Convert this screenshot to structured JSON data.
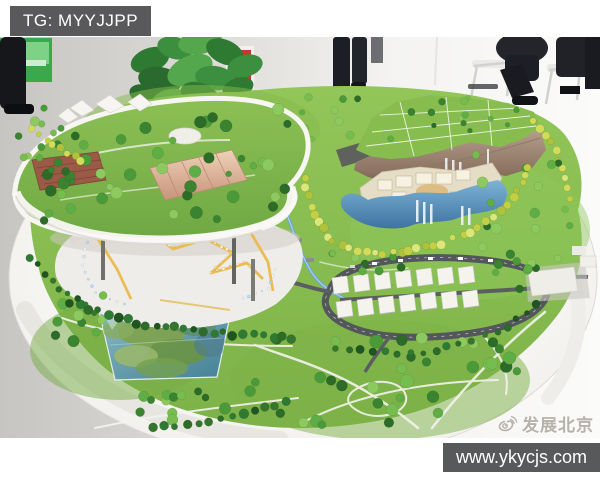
{
  "overlays": {
    "tag_badge": {
      "label": "TG: MYYJJPP",
      "bg": "#59595b",
      "text_color": "#ffffff"
    },
    "watermark": {
      "label": "发展北京",
      "icon": "weibo-logo",
      "color": "#b6b1a9"
    },
    "url_bar": {
      "label": "www.ykycjs.com",
      "bg": "#58595b",
      "text_color": "#fefefe"
    }
  },
  "photo": {
    "colors": {
      "lawn_green": "#86bc4e",
      "tree_dark_green": "#2c6b28",
      "tree_yellow_green": "#c8d44c",
      "water_blue": "#6fa9cf",
      "cliff_brown": "#a18977",
      "table_white": "#f4f3f0",
      "road_gray": "#53565a",
      "led_yellow": "#ecb94e",
      "floor_gray": "#c6c5c1"
    }
  }
}
